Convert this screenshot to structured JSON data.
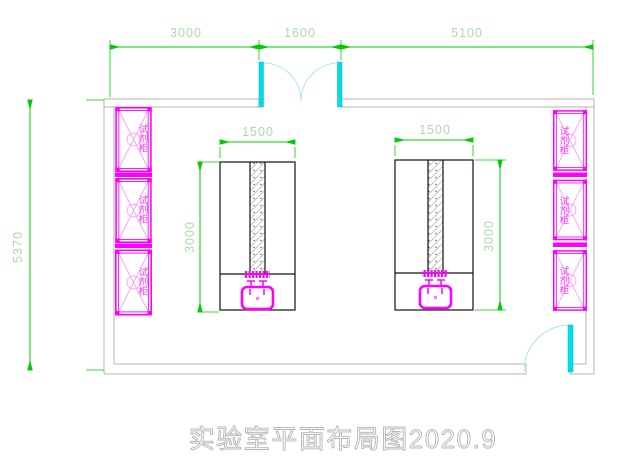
{
  "title": {
    "text": "实验室平面布局图2020.9"
  },
  "dimensions": {
    "top": [
      "3000",
      "1600",
      "5100"
    ],
    "left_height": "5370"
  },
  "benches": {
    "left": {
      "width_label": "1500",
      "depth_label": "3000"
    },
    "right": {
      "width_label": "1500",
      "depth_label": "3000"
    }
  },
  "cabinets": {
    "left": [
      {
        "label": "试剂柜"
      },
      {
        "label": "试剂柜"
      },
      {
        "label": "试剂柜"
      }
    ],
    "right": [
      {
        "label": "试剂柜"
      },
      {
        "label": "试剂柜"
      },
      {
        "label": "试剂柜"
      }
    ]
  },
  "colors": {
    "dimension_line": "#00cc00",
    "dimension_text": "#a9dca9",
    "cabinet_magenta": "#ff00ff",
    "door_cyan": "#00dde8",
    "door_arc": "#a5e9ef",
    "wall_gray": "#b3b3b3",
    "bench_outline": "#111111",
    "title_gray": "#b5b5b5",
    "background": "#ffffff"
  }
}
